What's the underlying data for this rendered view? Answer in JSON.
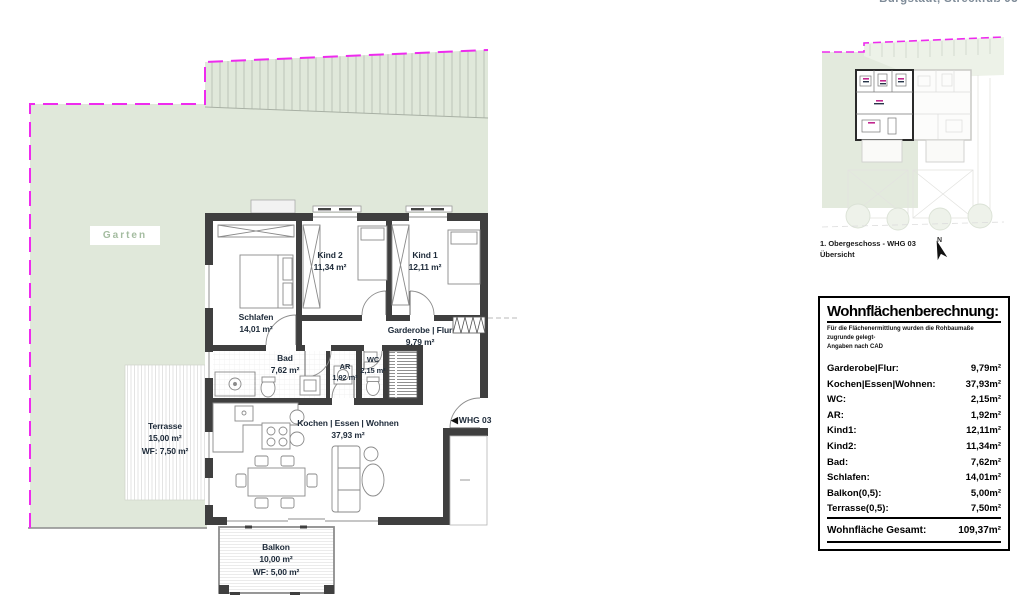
{
  "header": {
    "address": "Burgstädt, Streckfuß 93"
  },
  "site": {
    "garten_label": "Garten"
  },
  "rooms": {
    "kind2": {
      "name": "Kind 2",
      "area": "11,34 m²"
    },
    "kind1": {
      "name": "Kind 1",
      "area": "12,11 m²"
    },
    "schlafen": {
      "name": "Schlafen",
      "area": "14,01 m²"
    },
    "garderobe": {
      "name": "Garderobe | Flur",
      "area": "9,79 m²"
    },
    "bad": {
      "name": "Bad",
      "area": "7,62 m²"
    },
    "ar": {
      "name": "AR",
      "area": "1,92 m²"
    },
    "wc": {
      "name": "WC",
      "area": "2,15 m²"
    },
    "wohnen": {
      "name": "Kochen | Essen | Wohnen",
      "area": "37,93 m²"
    }
  },
  "terrasse": {
    "name": "Terrasse",
    "area": "15,00 m²",
    "wf": "WF: 7,50 m²"
  },
  "balkon": {
    "name": "Balkon",
    "area": "10,00 m²",
    "wf": "WF: 5,00 m²"
  },
  "entry": {
    "arrow": "◀",
    "label": "WHG 03"
  },
  "overview": {
    "caption_line1": "1. Obergeschoss - WHG 03",
    "caption_line2": "Übersicht",
    "north_label": "N"
  },
  "table": {
    "title": "Wohnflächenberechnung:",
    "subtitle1": "Für die Flächenermittlung wurden die Rohbaumaße zugrunde gelegt-",
    "subtitle2": "Angaben nach CAD",
    "rows": [
      {
        "label": "Garderobe|Flur:",
        "value": "9,79m²"
      },
      {
        "label": "Kochen|Essen|Wohnen:",
        "value": "37,93m²"
      },
      {
        "label": "WC:",
        "value": "2,15m²"
      },
      {
        "label": "AR:",
        "value": "1,92m²"
      },
      {
        "label": "Kind1:",
        "value": "12,11m²"
      },
      {
        "label": "Kind2:",
        "value": "11,34m²"
      },
      {
        "label": "Bad:",
        "value": "7,62m²"
      },
      {
        "label": "Schlafen:",
        "value": "14,01m²"
      },
      {
        "label": "Balkon(0,5):",
        "value": "5,00m²"
      },
      {
        "label": "Terrasse(0,5):",
        "value": "7,50m²"
      }
    ],
    "total": {
      "label": "Wohnfläche Gesamt:",
      "value": "109,37m²"
    }
  },
  "colors": {
    "garden_green": "#e0e8da",
    "wall_dark": "#3f3f3f",
    "boundary_magenta": "#ee2bee",
    "label_navy": "#1d2a39",
    "garten_text": "#a4bca0",
    "address_gray": "#7e8b98"
  }
}
